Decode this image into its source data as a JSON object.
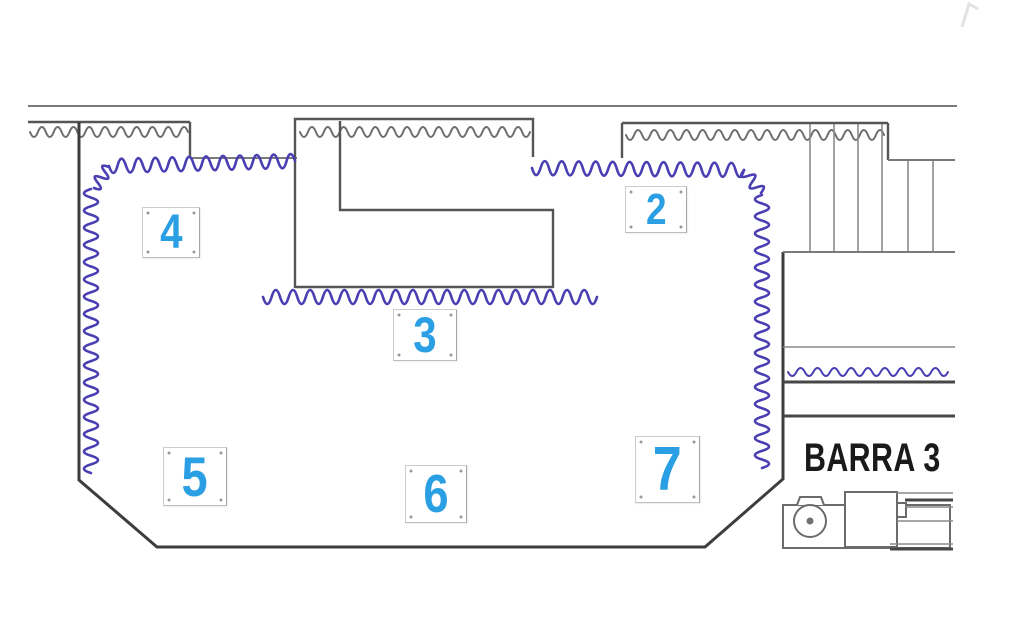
{
  "plan": {
    "zones": [
      {
        "id": "zone-2",
        "label": "2"
      },
      {
        "id": "zone-3",
        "label": "3"
      },
      {
        "id": "zone-4",
        "label": "4"
      },
      {
        "id": "zone-5",
        "label": "5"
      },
      {
        "id": "zone-6",
        "label": "6"
      },
      {
        "id": "zone-7",
        "label": "7"
      }
    ],
    "bar_label": "BARRA 3"
  },
  "colors": {
    "zone_number": "#2B9FE4",
    "curtain_zigzag": "#4A3EB3",
    "wall": "#3D3D3D",
    "light_line": "#8A8A8A",
    "hatch_zigzag": "#6E6E6E",
    "bar_text": "#1A1A1A",
    "background": "#FFFFFF"
  }
}
